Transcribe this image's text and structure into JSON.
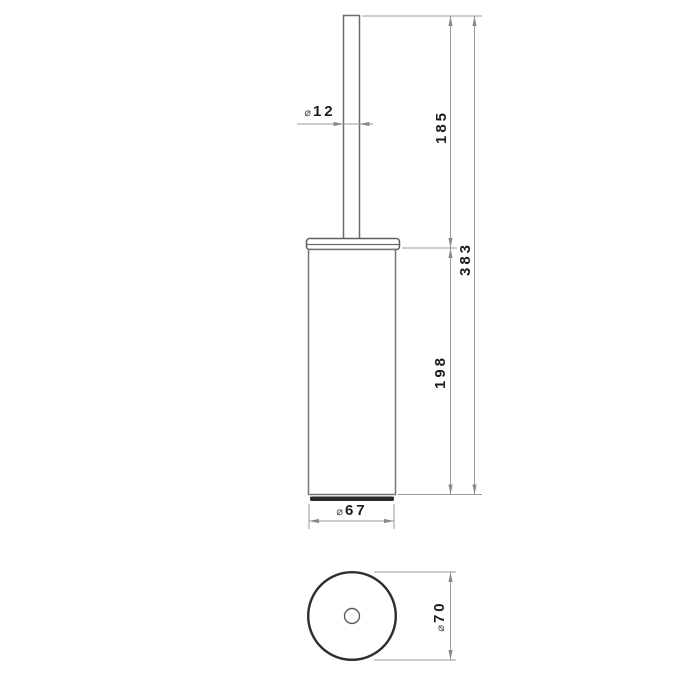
{
  "drawing": {
    "description": "Technical dimension drawing, front view and bottom view of a cylindrical brush holder",
    "front_view": {
      "rod_diameter": {
        "symbol": "⌀",
        "value": "12"
      },
      "handle_length": "185",
      "total_length": "383",
      "body_length": "198",
      "body_diameter": {
        "symbol": "⌀",
        "value": "67"
      }
    },
    "bottom_view": {
      "outer_diameter": {
        "symbol": "⌀",
        "value": "70"
      }
    },
    "colors": {
      "background": "#ffffff",
      "object_line": "#6a6a6a",
      "dark_accent": "#2a2a2a",
      "dimension_line": "#9b9b9b",
      "arrow": "#8a8a8a",
      "text": "#1c1c1c"
    }
  }
}
